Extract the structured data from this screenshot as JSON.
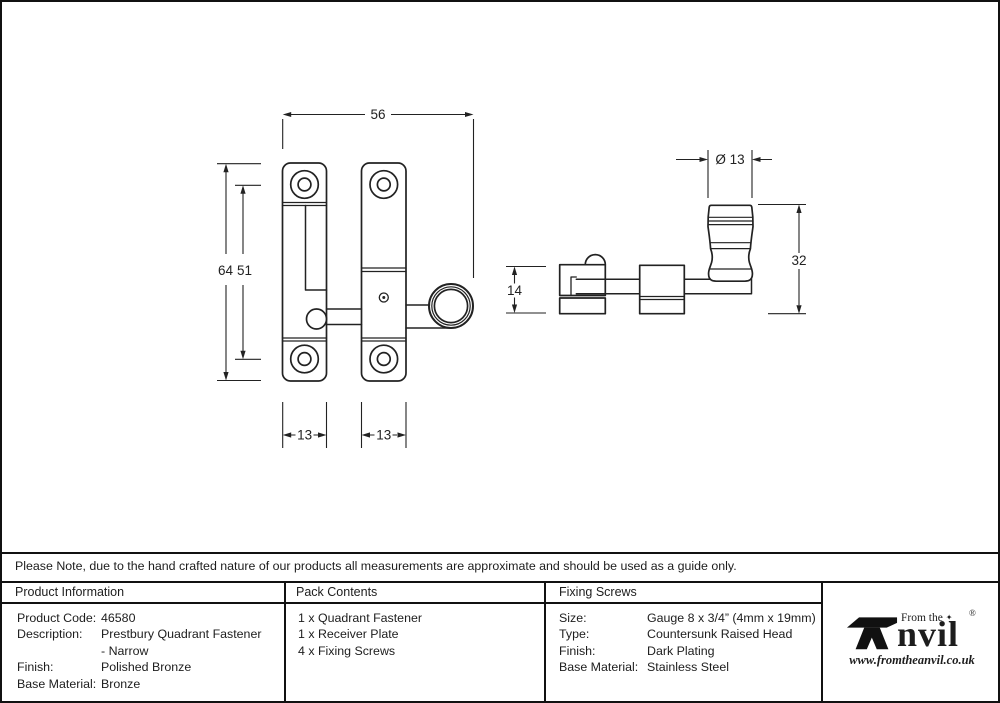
{
  "note": "Please Note, due to the hand crafted nature of our products all measurements are approximate and should be used as a guide only.",
  "drawing": {
    "front_view": {
      "overall_width": "56",
      "overall_height": "64",
      "hole_spacing": "51",
      "left_plate_width": "13",
      "right_plate_width": "13"
    },
    "side_view": {
      "knob_diameter": "Ø 13",
      "plate_depth": "14",
      "knob_height": "32"
    }
  },
  "table": {
    "product_information": {
      "header": "Product Information",
      "rows": [
        {
          "label": "Product Code:",
          "value": "46580"
        },
        {
          "label": "Description:",
          "value": "Prestbury Quadrant Fastener"
        },
        {
          "label": "",
          "value": "- Narrow"
        },
        {
          "label": "Finish:",
          "value": "Polished Bronze"
        },
        {
          "label": "Base Material:",
          "value": "Bronze"
        }
      ]
    },
    "pack_contents": {
      "header": "Pack Contents",
      "items": [
        "1 x Quadrant Fastener",
        "1 x Receiver Plate",
        "4 x Fixing Screws"
      ]
    },
    "fixing_screws": {
      "header": "Fixing Screws",
      "rows": [
        {
          "label": "Size:",
          "value": "Gauge 8 x 3/4” (4mm x 19mm)"
        },
        {
          "label": "Type:",
          "value": "Countersunk Raised Head"
        },
        {
          "label": "Finish:",
          "value": "Dark Plating"
        },
        {
          "label": "Base Material:",
          "value": "Stainless Steel"
        }
      ]
    }
  },
  "logo": {
    "from_the": "From the",
    "brand": "nvil",
    "registered": "®",
    "diamond": "✦",
    "website": "www.fromtheanvil.co.uk"
  },
  "colors": {
    "line": "#222222",
    "background": "#ffffff"
  }
}
